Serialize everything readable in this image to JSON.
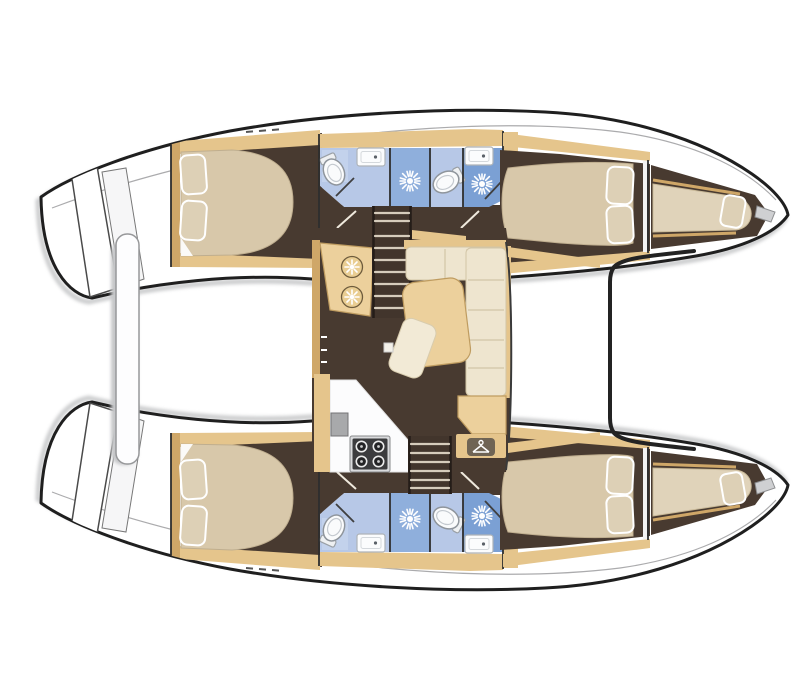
{
  "meta": {
    "title": "Catamaran yacht interior layout — top-view floor plan",
    "view": "plan"
  },
  "colors": {
    "background": "#ffffff",
    "hull_stroke": "#1f1f1f",
    "shadow": "#bcbdbf",
    "floor_dark": "#483a30",
    "stairwell": "#42352c",
    "tread": "#d6ccbc",
    "wood": "#e5c58c",
    "wood_dark": "#cfa768",
    "wood_light": "#ecd09c",
    "cream": "#eee5cf",
    "cream_line": "#d2c5a6",
    "bed": "#d8c8aa",
    "bed_dark": "#bfae8f",
    "pillow": "#ddd0b6",
    "blue_light": "#b7c8e7",
    "blue_pale": "#c3d2ec",
    "blue_mid": "#8fafdc",
    "blue_dark": "#7ba0d4",
    "fixture": "#f9fafb",
    "gray_line": "#9b9c9e",
    "steel": "#a8a9ab",
    "stove_dark": "#3c3c3e",
    "icon_dark": "#6f6454"
  },
  "labels": {
    "boat": "Catamaran interior layout, top view",
    "top_hull": "Port hull with cabins and bathrooms",
    "bottom_hull": "Starboard hull with cabins and bathrooms",
    "aft_cabin": "Aft double cabin with island bed and pillows",
    "forward_cabin": "Forward double cabin with island bed and pillows",
    "forepeak": "Forepeak single berth in bow",
    "bathroom": "Bathroom with toilet, washbasin and shower cubicle",
    "shower": "Shower head",
    "toilet": "Toilet",
    "sink": "Washbasin",
    "saloon": "Saloon with galley, table and L-shaped sofa",
    "galley": "Galley with twin sinks, stove and worktop",
    "galley_sinks": "Twin round galley sinks",
    "stove": "Four-burner stove",
    "table": "Saloon table",
    "chair": "Chair",
    "sofa": "L-shaped sofa",
    "nav_seat": "Chart table seat",
    "wardrobe": "Wardrobe locker",
    "stairs": "Companionway steps down into hull",
    "trampoline": "Bow trampoline between hulls",
    "cockpit": "Aft cockpit deck",
    "davits": "Stern davits platform bar",
    "transom": "Transom steps"
  },
  "inventory": {
    "hulls": 2,
    "double_cabins": 4,
    "bathrooms": 4,
    "shower_heads": 4,
    "toilets": 4,
    "washbasins": 4,
    "forepeak_berths": 2,
    "companionways": 2,
    "stove_burners": 4,
    "galley_sinks": 2,
    "saloon_tables": 1,
    "trampolines": 1
  }
}
